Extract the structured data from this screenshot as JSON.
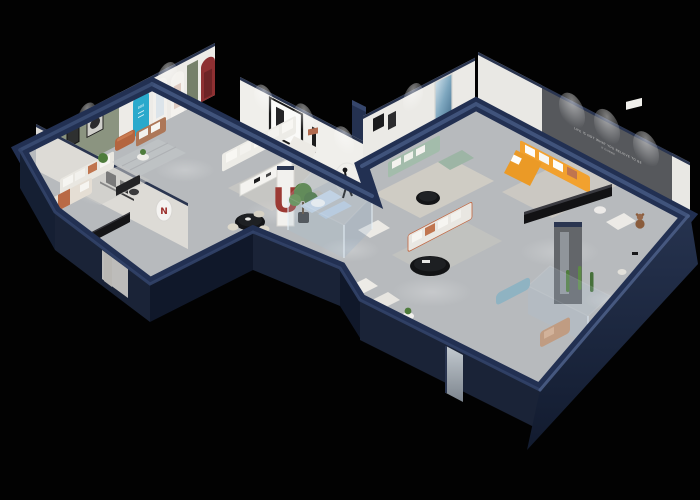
{
  "scene": {
    "title": "3D isometric cutaway floor-plan render of a furniture showroom",
    "style": "dollhouse axonometric view, spot-lit interiors on a black backdrop",
    "background": "#020202"
  },
  "palette": {
    "exterior_wall": "#223052",
    "exterior_wall_face": "#1a2337",
    "exterior_wall_shadow_face": "#10182a",
    "wall_top_highlight": "#44587f",
    "floor": "#b7babd",
    "interior_wall": "#ebeae6",
    "accent_wall_sage": "#8b9480",
    "accent_wall_dark_gray": "#56585c",
    "accent_teal": "#2aa9cc",
    "accent_red": "#9c3a34",
    "sofa_orange": "#f2a12e",
    "sofa_sage": "#a3bcab",
    "terracotta": "#c0754f",
    "furniture_black": "#131316",
    "furniture_white": "#edece7",
    "rug_cream": "#d9d4c8",
    "glass": "#bcd2e4",
    "plant_green": "#4e7c3c"
  },
  "texts": {
    "accent_wall_slogan_line1": "LIFE IS NOT WHAT YOU BELIEVE TO BE",
    "accent_wall_slogan_line2": "IT IS MORE",
    "arch_display_sign": "888",
    "oval_logo_mark": "N",
    "red_letter_sculpture": "U"
  },
  "rooms": [
    {
      "name": "bedroom-lounge",
      "accent": "sage green wall with framed art",
      "furniture": [
        "white sofa with terracotta pillows",
        "black writing desk and chair",
        "floor plant",
        "gray rug"
      ]
    },
    {
      "name": "lower-bedroom",
      "furniture": [
        "white daybed with terracotta throw",
        "long black media console",
        "wall shelf with black frames"
      ]
    },
    {
      "name": "entry-gallery",
      "furniture": [
        "teal arched display niche",
        "white arched poster niches",
        "olive arch door",
        "dark red arch niche",
        "caramel leather ottoman",
        "tan loveseat with white cushions",
        "round side table with plant",
        "striped gray rug"
      ]
    },
    {
      "name": "living-study",
      "furniture": [
        "white L-shaped sectional with pillows",
        "white dining table with black legs",
        "gray armchair with terracotta seat",
        "black figure sculpture with ring light",
        "large black-framed wall art"
      ]
    },
    {
      "name": "center-hall",
      "furniture": [
        "round black dining table with four cream chairs",
        "white pillar with red letter sculpture",
        "potted tree",
        "white armchair",
        "white sofa with terracotta piping",
        "black oval coffee table",
        "glass display cube with pale blue sectional",
        "pair of white armchairs",
        "white side table with plant",
        "mirror door panel"
      ]
    },
    {
      "name": "showroom-lounge",
      "accent": "white wall with blue abstract art",
      "furniture": [
        "sage green sofa set with white pillows",
        "black round coffee table",
        "cream rug"
      ]
    },
    {
      "name": "main-showroom",
      "accent": "dark gray slogan wall",
      "furniture": [
        "orange L-shaped sofa with white pillows",
        "long black media console",
        "white armchair",
        "teddy-bear figure",
        "white side table",
        "gray partition with mirror",
        "glass display case with cacti",
        "pale blue bench",
        "beige recliner",
        "white desk with chair"
      ]
    }
  ],
  "lighting": [
    "ceiling spotlights washing the walls",
    "soft light pools on the floor"
  ]
}
